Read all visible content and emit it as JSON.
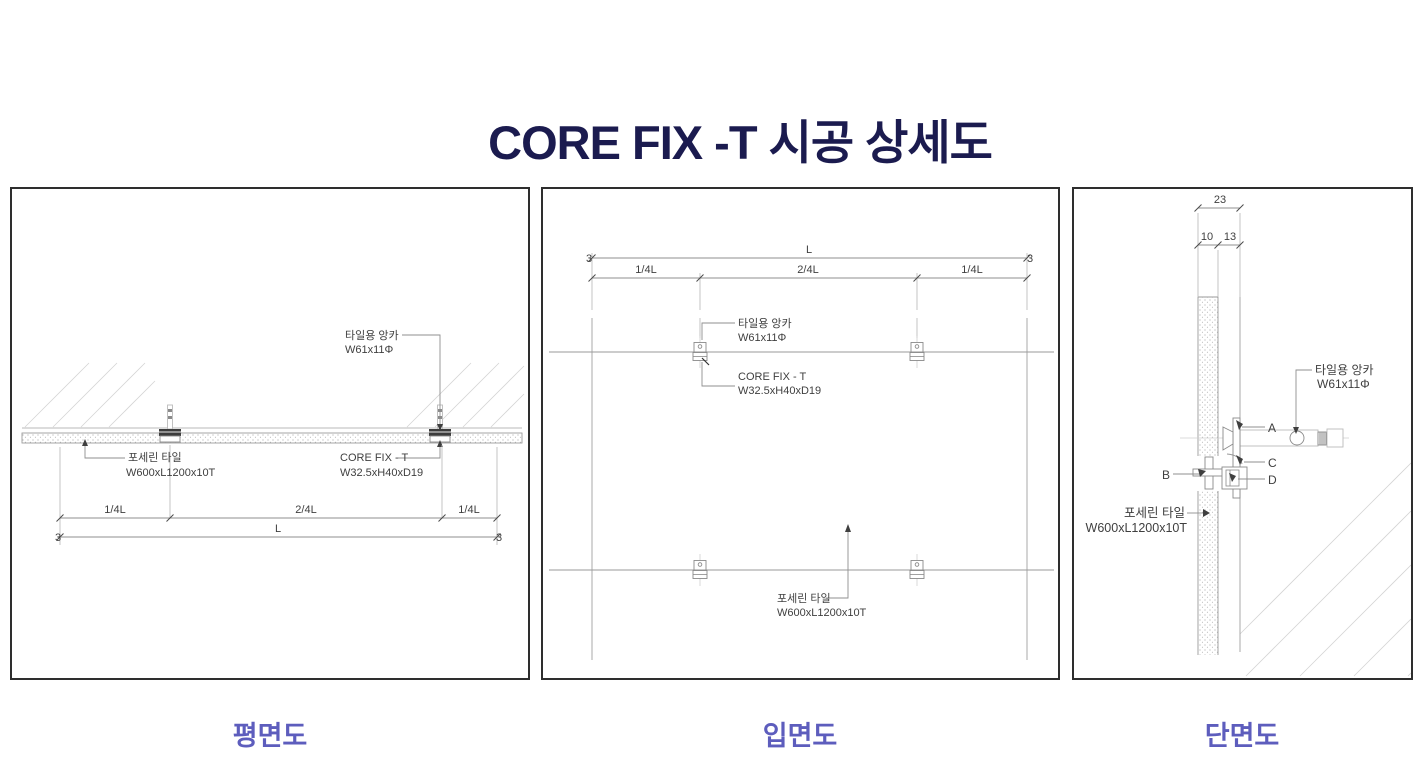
{
  "title": "CORE FIX -T 시공 상세도",
  "colors": {
    "title": "#1b1b4f",
    "caption": "#5d5dbd",
    "line_dark": "#3f3f3f",
    "line_light": "#9a9a9a"
  },
  "plan": {
    "caption": "평면도",
    "anchor_label_1": "타일용 앙카",
    "anchor_label_2": "W61x11Φ",
    "tile_label_1": "포세린 타일",
    "tile_label_2": "W600xL1200x10T",
    "corefix_label_1": "CORE FIX - T",
    "corefix_label_2": "W32.5xH40xD19",
    "dim_q1": "1/4L",
    "dim_mid": "2/4L",
    "dim_q3": "1/4L",
    "dim_total": "L",
    "dim_end_left": "3",
    "dim_end_right": "3"
  },
  "elevation": {
    "caption": "입면도",
    "anchor_label_1": "타일용 앙카",
    "anchor_label_2": "W61x11Φ",
    "corefix_label_1": "CORE FIX - T",
    "corefix_label_2": "W32.5xH40xD19",
    "tile_label_1": "포세린 타일",
    "tile_label_2": "W600xL1200x10T",
    "dim_q1": "1/4L",
    "dim_mid": "2/4L",
    "dim_q3": "1/4L",
    "dim_total": "L",
    "dim_end_left": "3",
    "dim_end_right": "3"
  },
  "section": {
    "caption": "단면도",
    "anchor_label_1": "타일용 앙카",
    "anchor_label_2": "W61x11Φ",
    "tile_label_1": "포세린 타일",
    "tile_label_2": "W600xL1200x10T",
    "dim_total": "23",
    "dim_tile": "10",
    "dim_gap": "13",
    "part_a": "A",
    "part_b": "B",
    "part_c": "C",
    "part_d": "D"
  }
}
